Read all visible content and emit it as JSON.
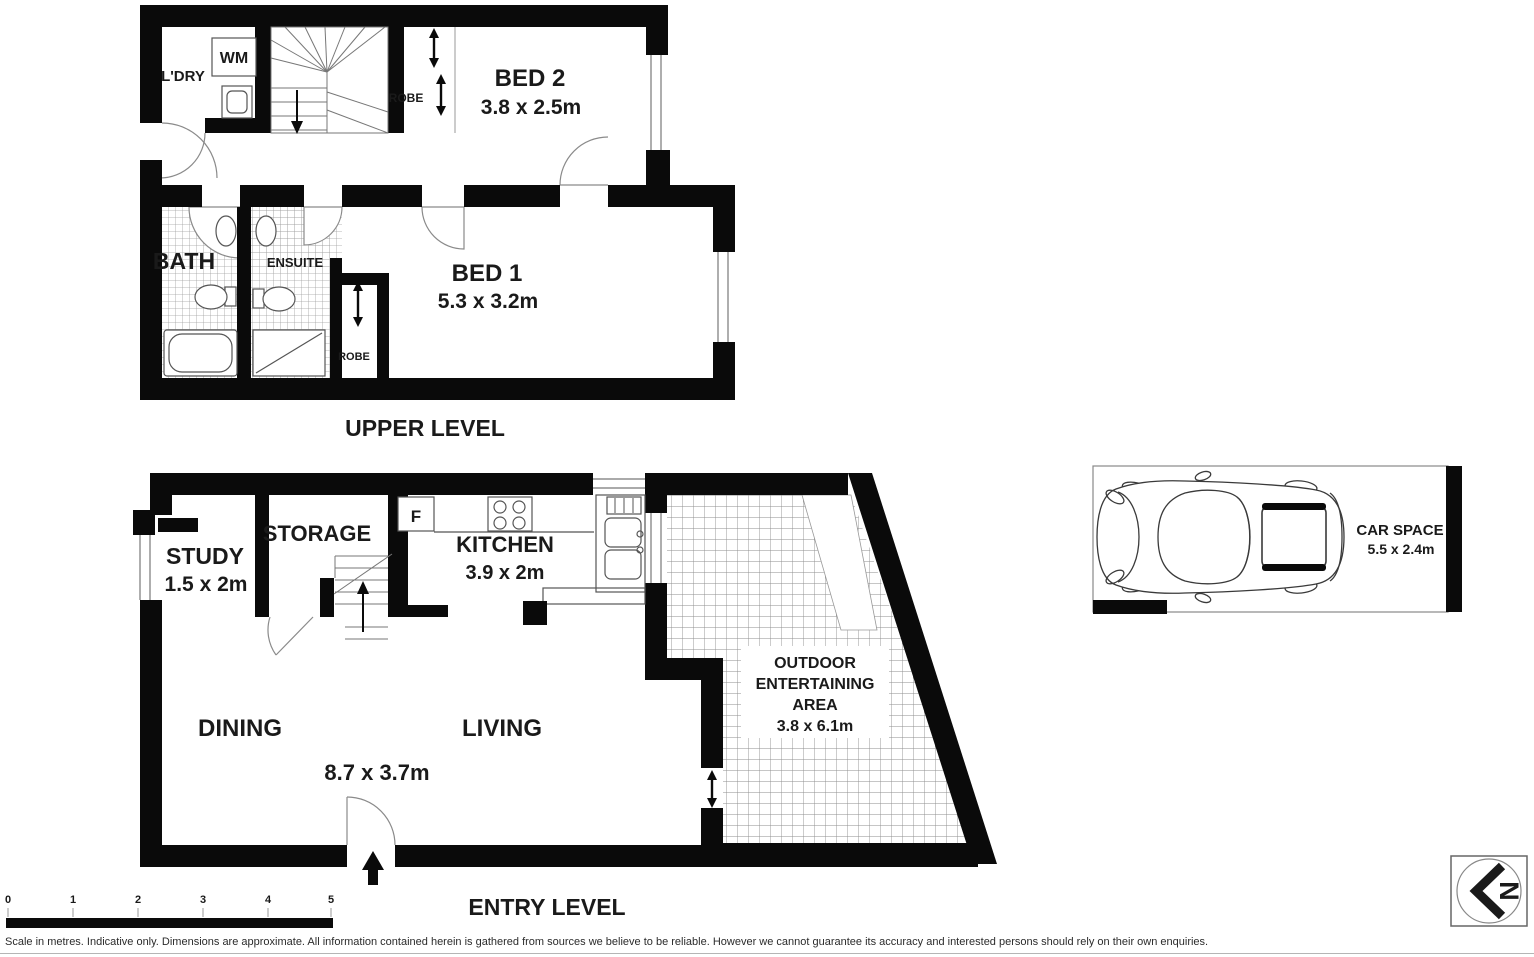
{
  "upper_level": {
    "title": "UPPER LEVEL",
    "laundry": "L'DRY",
    "washing_machine": "WM",
    "robe_top": "ROBE",
    "bed2_name": "BED 2",
    "bed2_dims": "3.8 x 2.5m",
    "bath": "BATH",
    "ensuite": "ENSUITE",
    "robe_lower": "ROBE",
    "bed1_name": "BED 1",
    "bed1_dims": "5.3 x 3.2m"
  },
  "entry_level": {
    "title": "ENTRY LEVEL",
    "study_name": "STUDY",
    "study_dims": "1.5 x 2m",
    "storage": "STORAGE",
    "fridge": "F",
    "kitchen_name": "KITCHEN",
    "kitchen_dims": "3.9 x 2m",
    "dining": "DINING",
    "living": "LIVING",
    "living_dining_dims": "8.7 x 3.7m",
    "outdoor_line1": "OUTDOOR",
    "outdoor_line2": "ENTERTAINING",
    "outdoor_line3": "AREA",
    "outdoor_dims": "3.8 x 6.1m"
  },
  "car_space": {
    "name": "CAR SPACE",
    "dims": "5.5 x 2.4m"
  },
  "scale_bar": {
    "ticks": [
      "0",
      "1",
      "2",
      "3",
      "4",
      "5"
    ]
  },
  "compass": {
    "north": "N"
  },
  "disclaimer": "Scale in metres. Indicative only. Dimensions are approximate. All information contained herein is gathered from sources we believe to be reliable. However we cannot guarantee its accuracy and interested persons should rely on their own enquiries.",
  "colors": {
    "wall": "#0a0a0a",
    "tile_line": "#a0a0a0",
    "text": "#1a1a1a"
  }
}
